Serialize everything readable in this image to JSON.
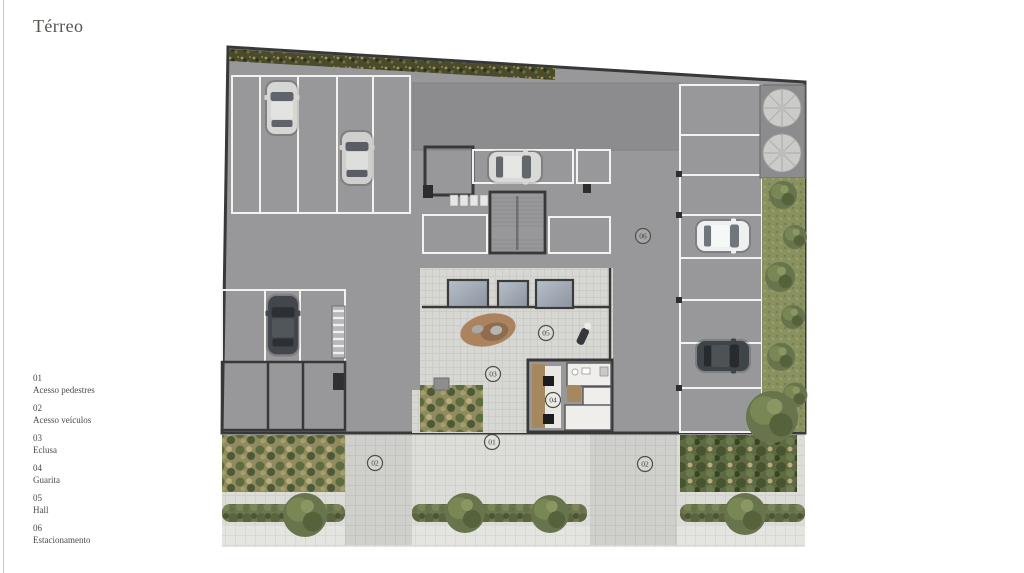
{
  "page": {
    "title": "Térreo"
  },
  "legend": [
    {
      "num": "01",
      "label": "Acesso pedestres"
    },
    {
      "num": "02",
      "label": "Acesso veículos"
    },
    {
      "num": "03",
      "label": "Eclusa"
    },
    {
      "num": "04",
      "label": "Guarita"
    },
    {
      "num": "05",
      "label": "Hall"
    },
    {
      "num": "06",
      "label": "Estacionamento"
    }
  ],
  "plan": {
    "markers": [
      {
        "key": "acesso-pedestres",
        "label": "01",
        "transform": "translate(277,397)"
      },
      {
        "key": "acesso-veiculos-esquerda",
        "label": "02",
        "transform": "translate(160,418)"
      },
      {
        "key": "acesso-veiculos-direita",
        "label": "02",
        "transform": "translate(430,419)"
      },
      {
        "key": "eclusa",
        "label": "03",
        "transform": "translate(278,329)"
      },
      {
        "key": "guarita",
        "label": "04",
        "transform": "translate(338,355)"
      },
      {
        "key": "hall",
        "label": "05",
        "transform": "translate(331,288)"
      },
      {
        "key": "estacionamento",
        "label": "06",
        "transform": "translate(428,191)"
      }
    ]
  },
  "colors": {
    "background": "#ffffff",
    "text": "#55544e",
    "rule": "#c9c9c6",
    "floor": "#98989b",
    "wall": "#383838",
    "paving": "#dcdcd8",
    "vegetation": "#6b7750",
    "wood": "#a5885e",
    "glass": "#a2aab6"
  }
}
